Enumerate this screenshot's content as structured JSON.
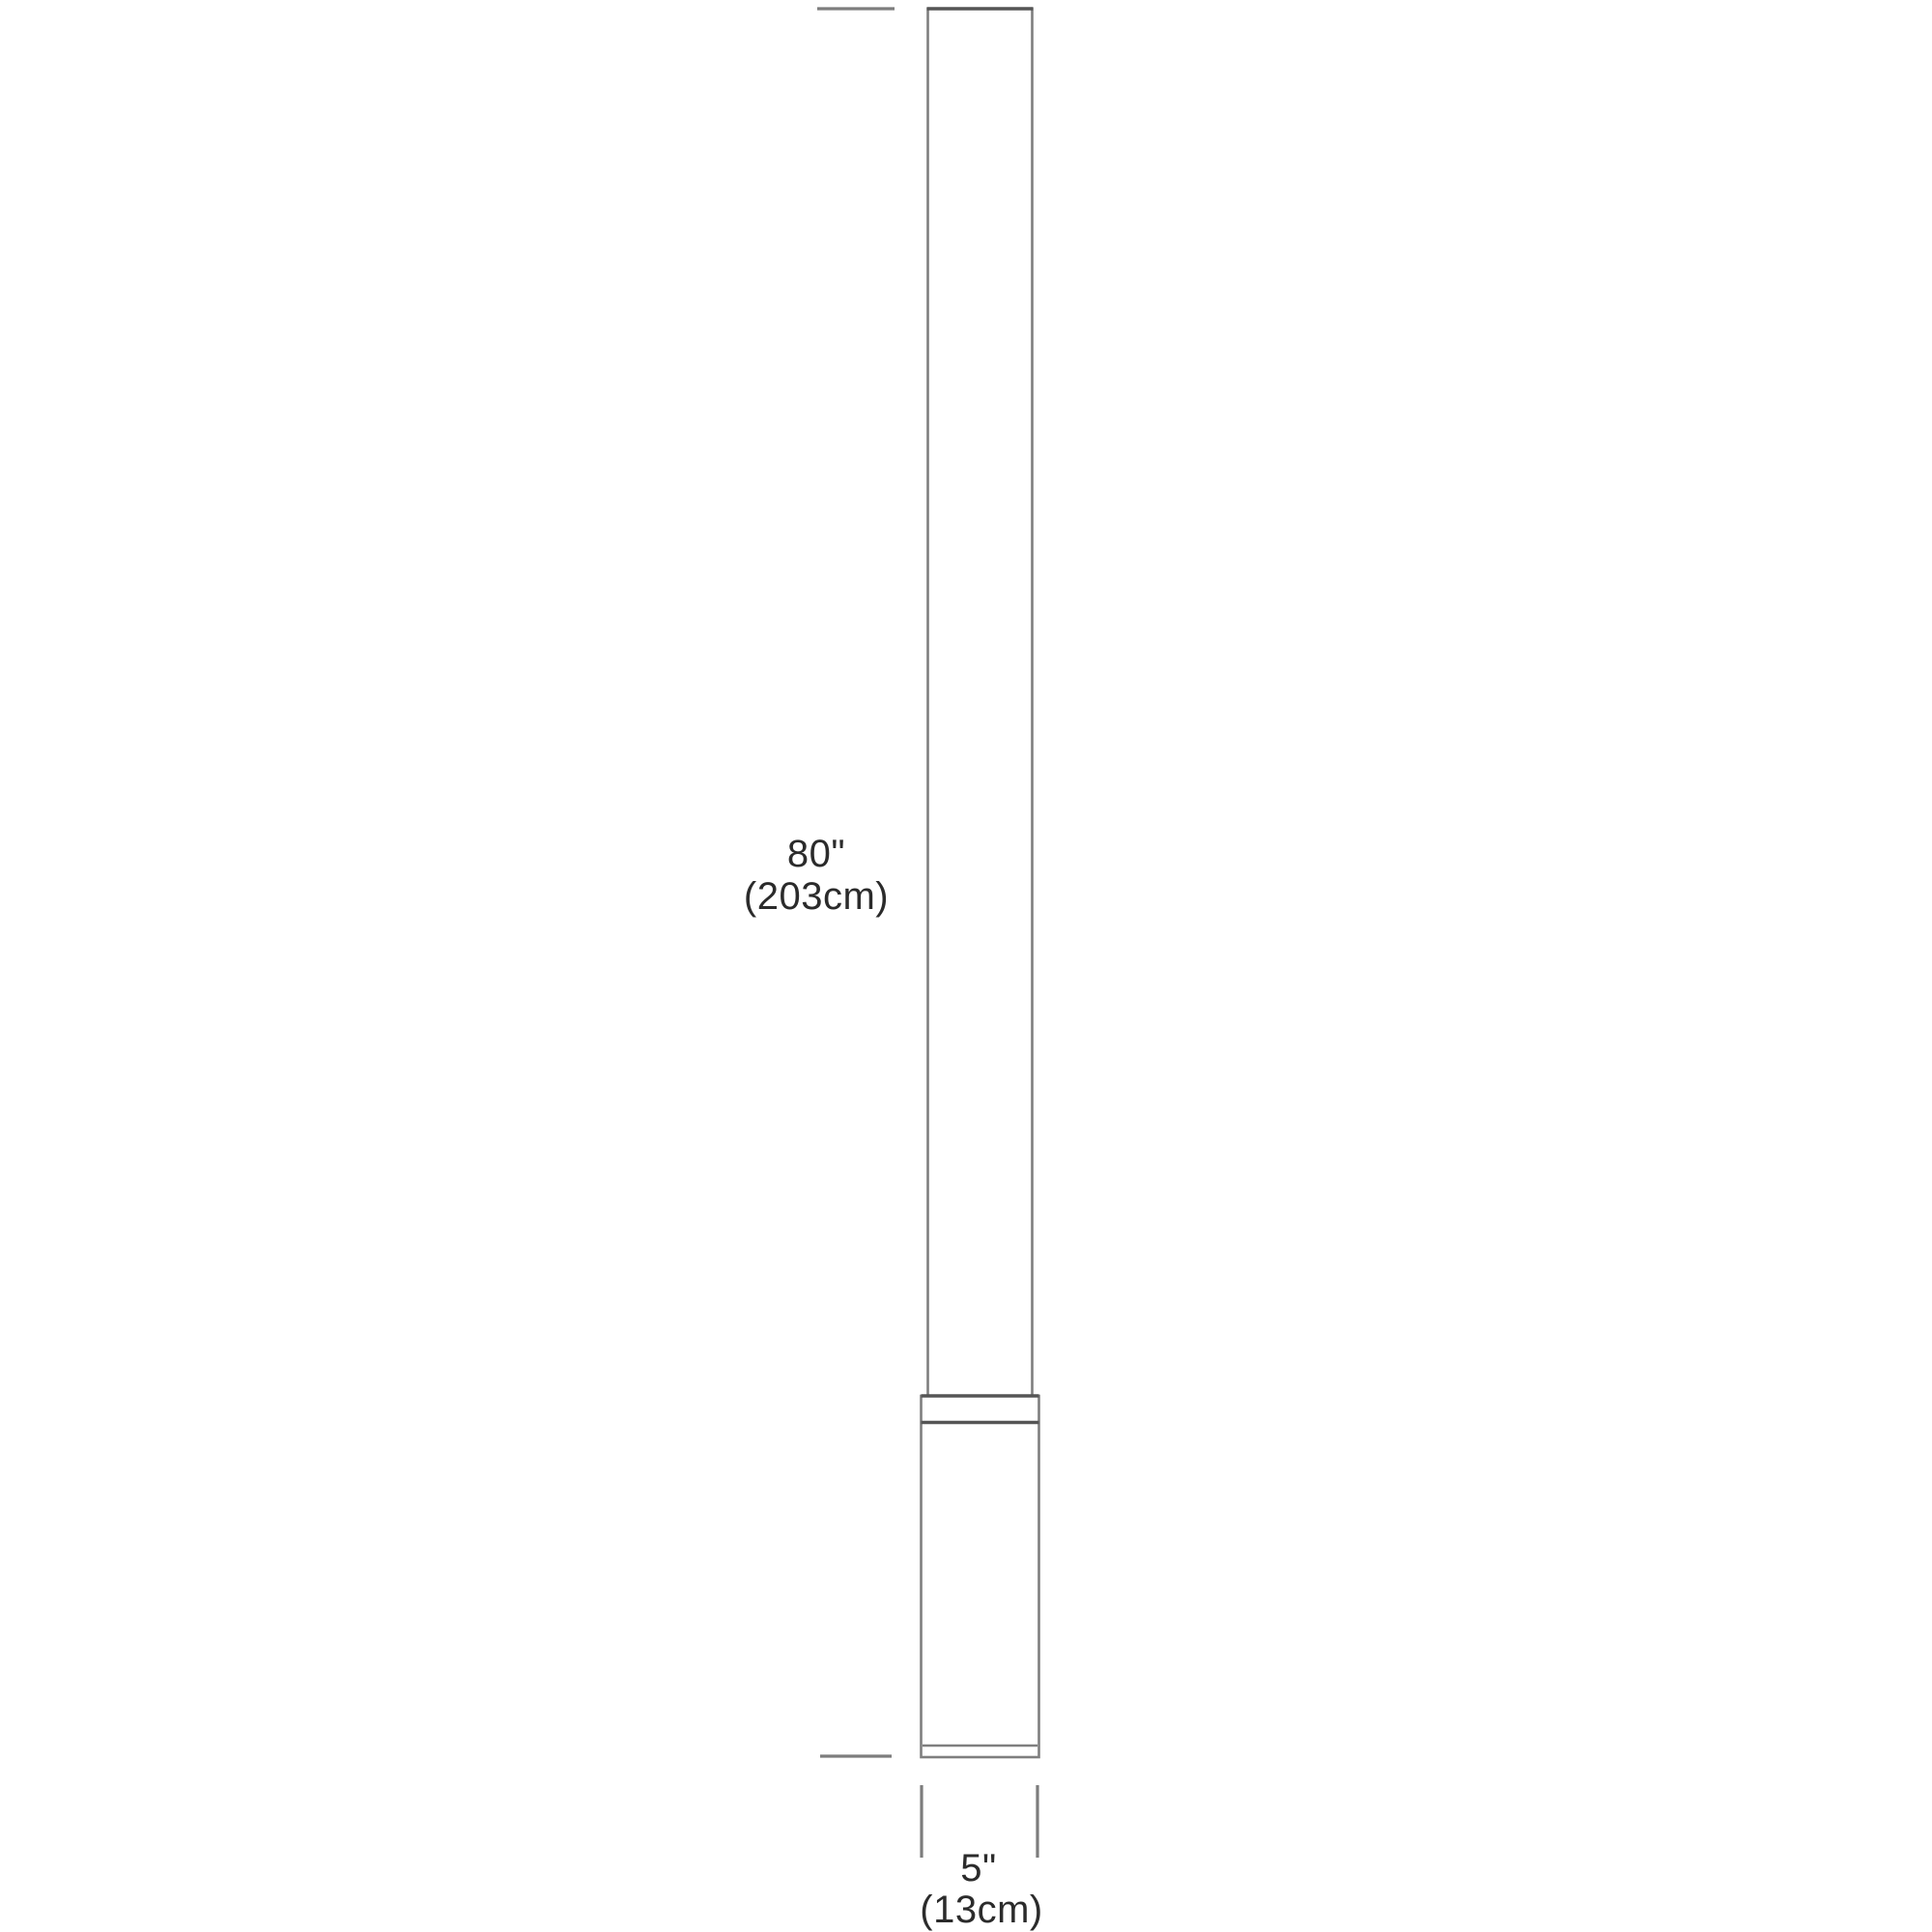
{
  "diagram": {
    "kind": "product-dimension-drawing",
    "subject": "cylindrical floor lamp with base",
    "height_label": {
      "inches": "80\"",
      "metric": "(203cm)"
    },
    "width_label": {
      "inches": "5\"",
      "metric": "(13cm)"
    },
    "colors": {
      "outline": "#7f7f7f",
      "outline_dark": "#555555",
      "dimension_line": "#7d7d7d",
      "text": "#2b2b2b",
      "background": "#ffffff"
    }
  }
}
